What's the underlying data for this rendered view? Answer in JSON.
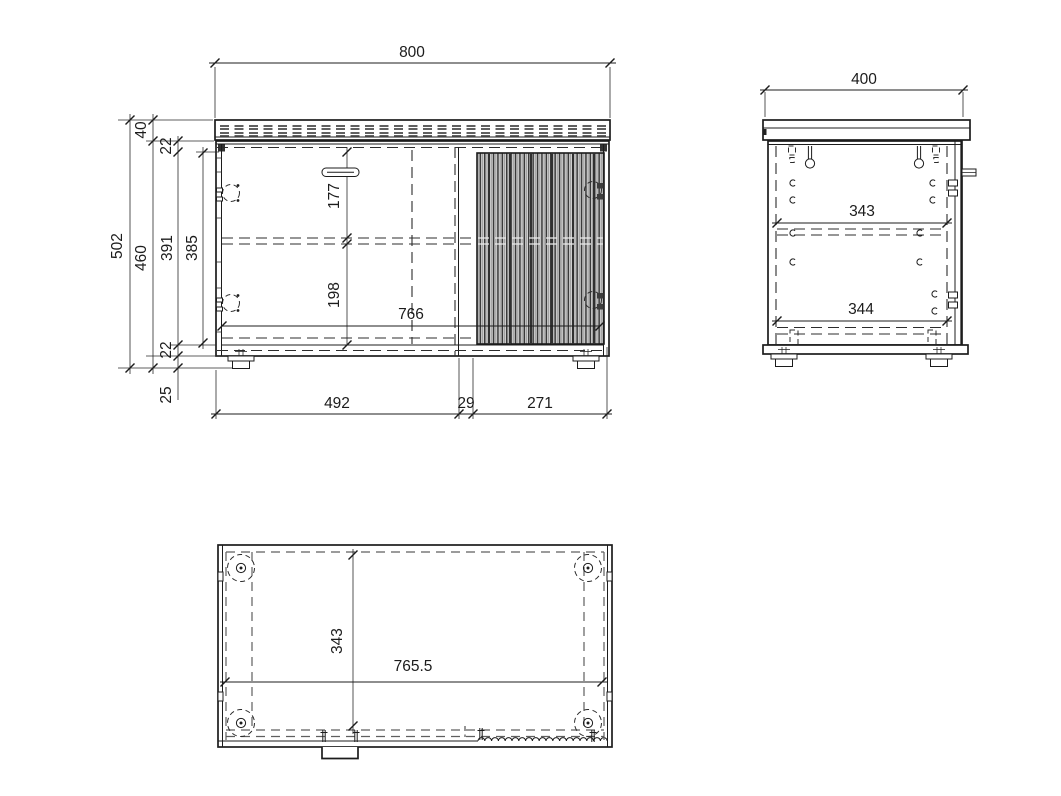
{
  "title": "Cabinet technical drawing",
  "front_view": {
    "dim_width": "800",
    "dim_top_panel": "40",
    "dim_top_rail": "22",
    "dim_total_height": "502",
    "dim_body_height": "460",
    "dim_inner_height_back": "391",
    "dim_inner_height_front": "385",
    "dim_handle_to_shelf": "177",
    "dim_shelf_to_bottom": "198",
    "dim_inner_width": "766",
    "dim_bottom_rail": "22",
    "dim_leg_height": "25",
    "dim_left_door_width": "492",
    "dim_door_gap": "29",
    "dim_right_door_width": "271"
  },
  "side_view": {
    "dim_depth": "400",
    "dim_shelf_depth": "343",
    "dim_base_depth": "344"
  },
  "bottom_view": {
    "dim_inner_depth": "343",
    "dim_inner_width": "765.5"
  }
}
